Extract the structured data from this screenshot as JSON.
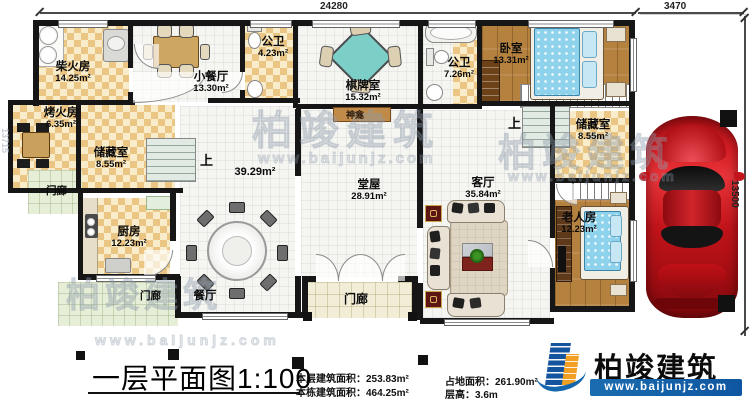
{
  "dims": {
    "top_main": "24280",
    "top_garage": "3470",
    "right": "13500",
    "left": "13715"
  },
  "rooms": [
    {
      "name": "柴火房",
      "area": "14.25m²"
    },
    {
      "name": "烤火房",
      "area": "6.35m²"
    },
    {
      "name": "储藏室",
      "area": "8.55m²"
    },
    {
      "name": "小餐厅",
      "area": "13.30m²"
    },
    {
      "name": "公卫",
      "area": "4.23m²"
    },
    {
      "name": "棋牌室",
      "area": "15.32m²"
    },
    {
      "name": "公卫",
      "area": "7.26m²"
    },
    {
      "name": "卧室",
      "area": "13.31m²"
    },
    {
      "name": "储藏室",
      "area": "8.55m²"
    },
    {
      "name": "餐厅",
      "area": "39.29m²"
    },
    {
      "name": "厨房",
      "area": "12.23m²"
    },
    {
      "name": "堂屋",
      "area": "28.91m²"
    },
    {
      "name": "客厅",
      "area": "35.84m²"
    },
    {
      "name": "老人房",
      "area": "12.23m²"
    }
  ],
  "labels": {
    "porch": "门廊",
    "shrine": "神龛",
    "up": "上"
  },
  "titleblock": {
    "title": "一层平面图1:100",
    "stats": {
      "s1": "本层建筑面积：253.83m²",
      "s2": "本栋建筑面积：464.25m²",
      "s3": "占地面积：261.90m²",
      "s4": "层高：3.6m"
    }
  },
  "brand": {
    "name": "柏竣建筑",
    "site": "www.baijunjz.com"
  }
}
